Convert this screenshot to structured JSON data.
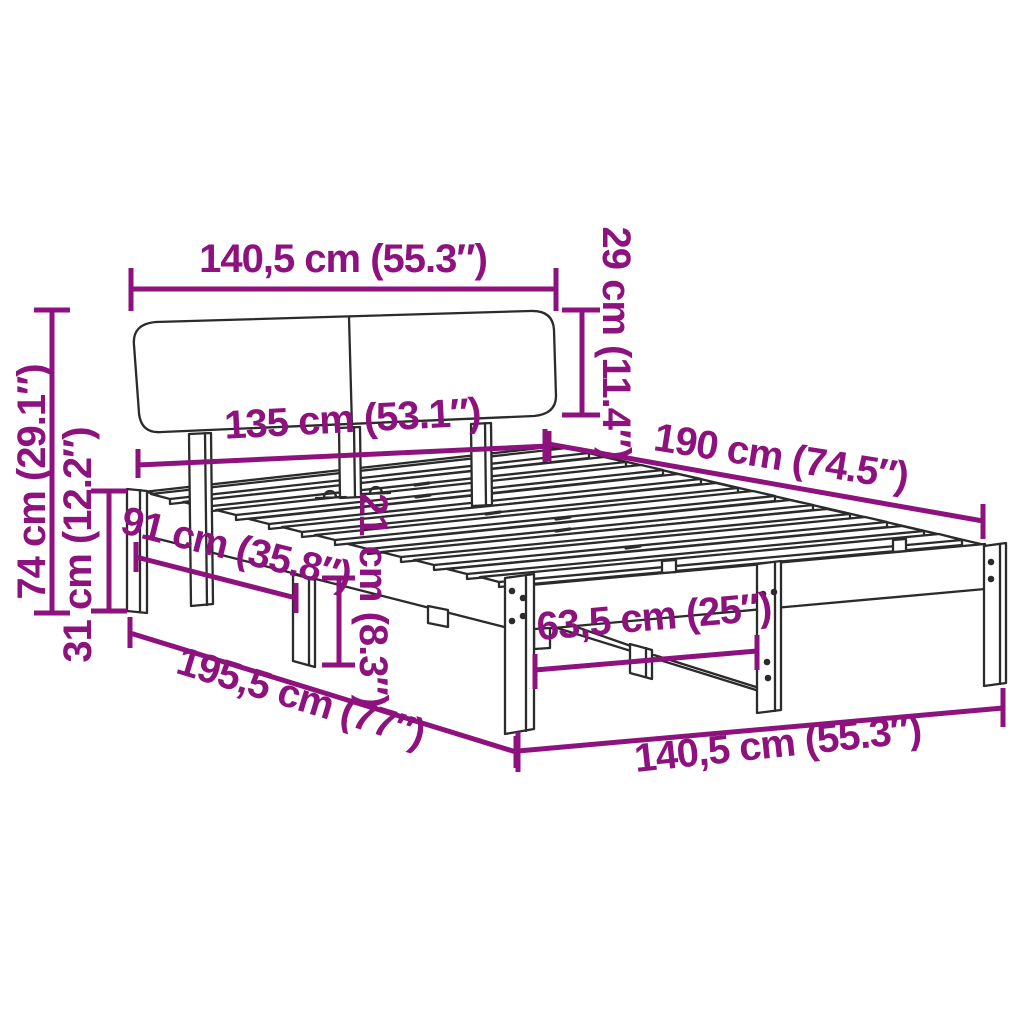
{
  "diagram": {
    "subject": "bed-frame-with-headboard-dimension-diagram",
    "colors": {
      "accent": "#8E127E",
      "outline": "#2B2B2B",
      "background": "#FFFFFF"
    },
    "dims": {
      "headboard_width": "140,5 cm (55.3″)",
      "headboard_height": "29 cm (11.4″)",
      "total_height": "74 cm (29.1″)",
      "base_height": "31 cm (12.2″)",
      "frame_width": "135 cm (53.1″)",
      "frame_length": "190 cm (74.5″)",
      "side_leg_span": "91 cm (35.8″)",
      "clearance_height": "21 cm (8.3″)",
      "foot_leg_span": "63,5 cm (25″)",
      "overall_length": "195,5 cm (77″)",
      "overall_width": "140,5 cm (55.3″)"
    }
  }
}
